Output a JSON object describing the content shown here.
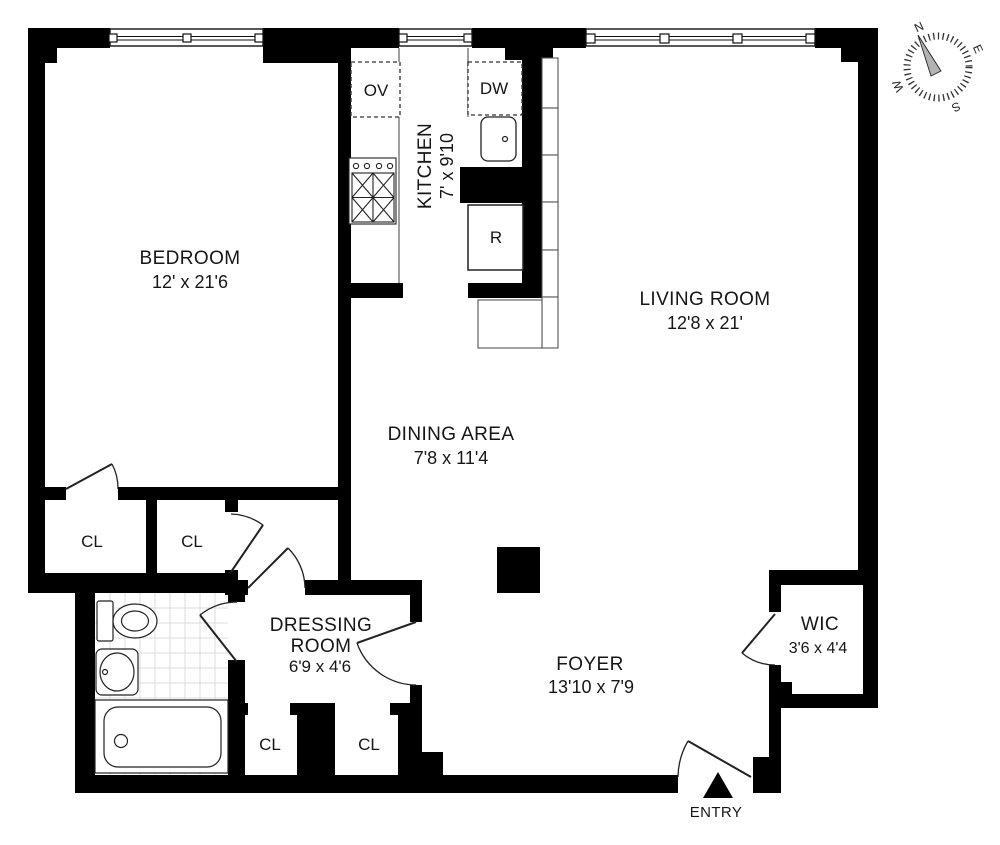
{
  "colors": {
    "background": "#ffffff",
    "walls": "#000000",
    "lines": "#1c1c1c",
    "tile": "#dcdcdc",
    "needle": "#b3b3b3"
  },
  "rooms": {
    "bedroom": {
      "name": "BEDROOM",
      "dims": "12' x 21'6"
    },
    "kitchen": {
      "name": "KITCHEN",
      "dims": "7' x 9'10"
    },
    "living": {
      "name": "LIVING ROOM",
      "dims": "12'8 x 21'"
    },
    "dining": {
      "name": "DINING AREA",
      "dims": "7'8 x 11'4"
    },
    "dressing": {
      "line1": "DRESSING",
      "line2": "ROOM",
      "dims": "6'9 x 4'6"
    },
    "foyer": {
      "name": "FOYER",
      "dims": "13'10 x 7'9"
    },
    "wic": {
      "name": "WIC",
      "dims": "3'6 x 4'4"
    }
  },
  "closets": {
    "cl1": "CL",
    "cl2": "CL",
    "cl3": "CL",
    "cl4": "CL"
  },
  "appliances": {
    "oven": "OV",
    "dishwasher": "DW",
    "refrigerator": "R"
  },
  "entry_label": "ENTRY",
  "compass": {
    "n": "N",
    "e": "E",
    "s": "S",
    "w": "W"
  }
}
